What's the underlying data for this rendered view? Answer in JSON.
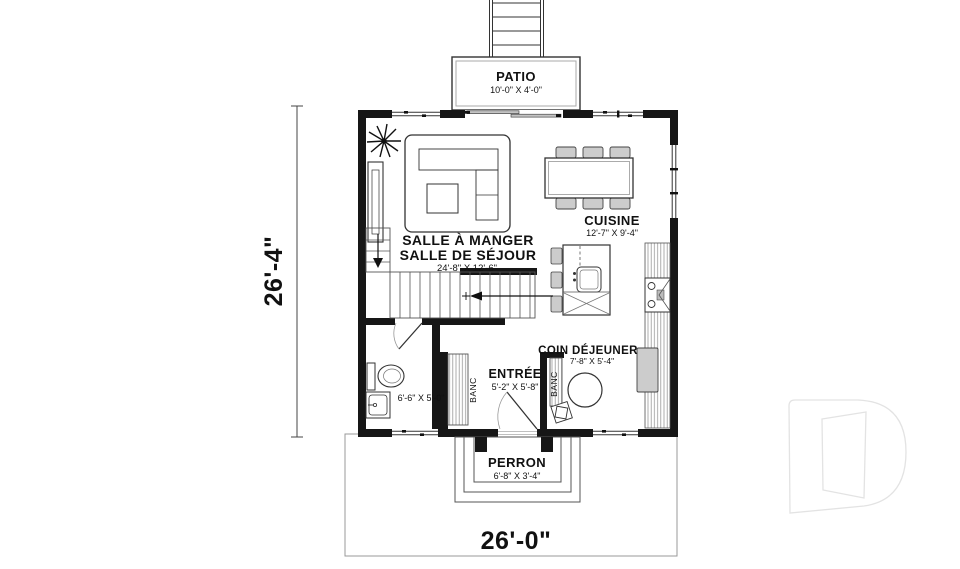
{
  "rooms": {
    "patio": {
      "name": "PATIO",
      "dims": "10'-0\" X 4'-0\""
    },
    "living_dining": {
      "name_line1": "SALLE À MANGER",
      "name_line2": "SALLE DE SÉJOUR",
      "dims": "24'-8\" X 12'-6\""
    },
    "kitchen": {
      "name": "CUISINE",
      "dims": "12'-7\" X 9'-4\""
    },
    "breakfast_nook": {
      "name": "COIN DÉJEUNER",
      "dims": "7'-8\" X 5'-4\""
    },
    "entry": {
      "name": "ENTRÉE",
      "dims": "5'-2\" X 5'-8\""
    },
    "bathroom": {
      "dims": "6'-6\" X 5'-0\""
    },
    "porch": {
      "name": "PERRON",
      "dims": "6'-8\" X 3'-4\""
    }
  },
  "fixtures": {
    "bench_left": "BANC",
    "bench_right": "BANC"
  },
  "overall_dimensions": {
    "width": "26'-0\"",
    "depth": "26'-4\""
  },
  "colors": {
    "wall": "#161616",
    "line": "#444444",
    "furniture_fill": "#cccccc",
    "hatch": "#999999",
    "watermark": "#e3e3e3",
    "background": "#ffffff"
  }
}
